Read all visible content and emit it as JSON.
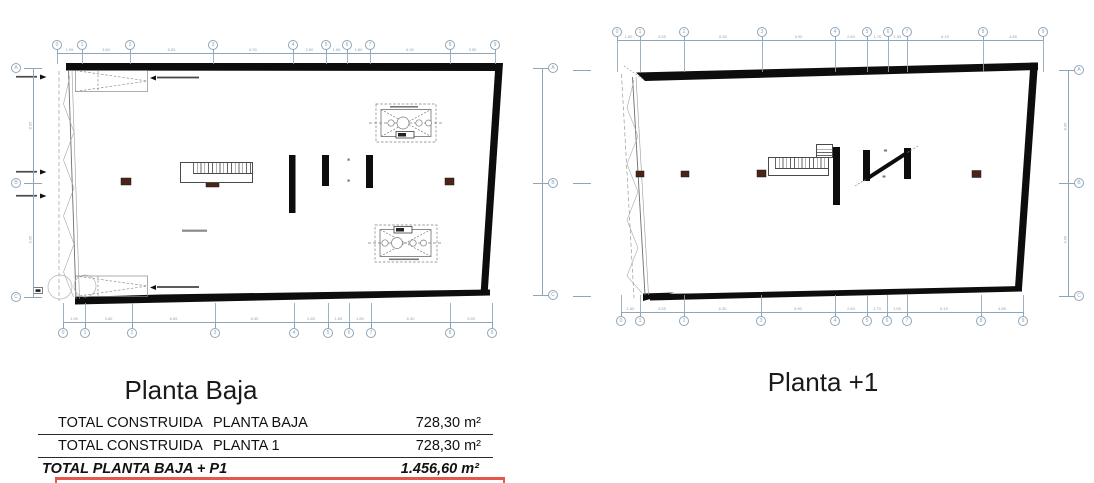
{
  "titles": {
    "left_plan": "Planta Baja",
    "right_plan": "Planta +1"
  },
  "area_table": {
    "rows": [
      {
        "label": "TOTAL CONSTRUIDA",
        "sublabel": "PLANTA BAJA",
        "value": "728,30 m²"
      },
      {
        "label": "TOTAL CONSTRUIDA",
        "sublabel": "PLANTA 1",
        "value": "728,30 m²"
      }
    ],
    "total": {
      "label": "TOTAL PLANTA BAJA + P1",
      "value": "1.456,60 m²"
    }
  },
  "plans": {
    "left": {
      "name": "Planta Baja",
      "grid_labels": [
        "0",
        "1",
        "2",
        "3",
        "4",
        "5",
        "6",
        "7",
        "8",
        "9"
      ],
      "side_labels": [
        "A",
        "B",
        "C"
      ],
      "dims_top": [
        "1.95",
        "3.80",
        "6.55",
        "6.30",
        "2.60",
        "1.65",
        "1.80",
        "6.30",
        "3.55"
      ],
      "dims_bottom": [
        "1.95",
        "3.80",
        "6.55",
        "6.30",
        "2.60",
        "1.65",
        "1.80",
        "6.30",
        "3.55"
      ],
      "dims_side": [
        "8.95",
        "9.05"
      ]
    },
    "right": {
      "name": "Planta +1",
      "grid_labels": [
        "0",
        "1",
        "2",
        "3",
        "4",
        "5",
        "6",
        "7",
        "8",
        "9"
      ],
      "side_labels": [
        "A",
        "B",
        "C"
      ],
      "dims_top": [
        "1.80",
        "3.55",
        "6.30",
        "5.90",
        "2.60",
        "1.70",
        "1.55",
        "6.15",
        "4.85"
      ],
      "dims_bottom": [
        "1.80",
        "3.55",
        "6.30",
        "5.90",
        "2.60",
        "1.70",
        "1.55",
        "6.15",
        "4.85"
      ],
      "dims_side": [
        "8.95",
        "9.05"
      ]
    }
  },
  "colors": {
    "dimension": "#8fa6b8",
    "wall": "#0d0d0d",
    "column": "#4a2417",
    "table_rule_red": "#e4574d"
  }
}
